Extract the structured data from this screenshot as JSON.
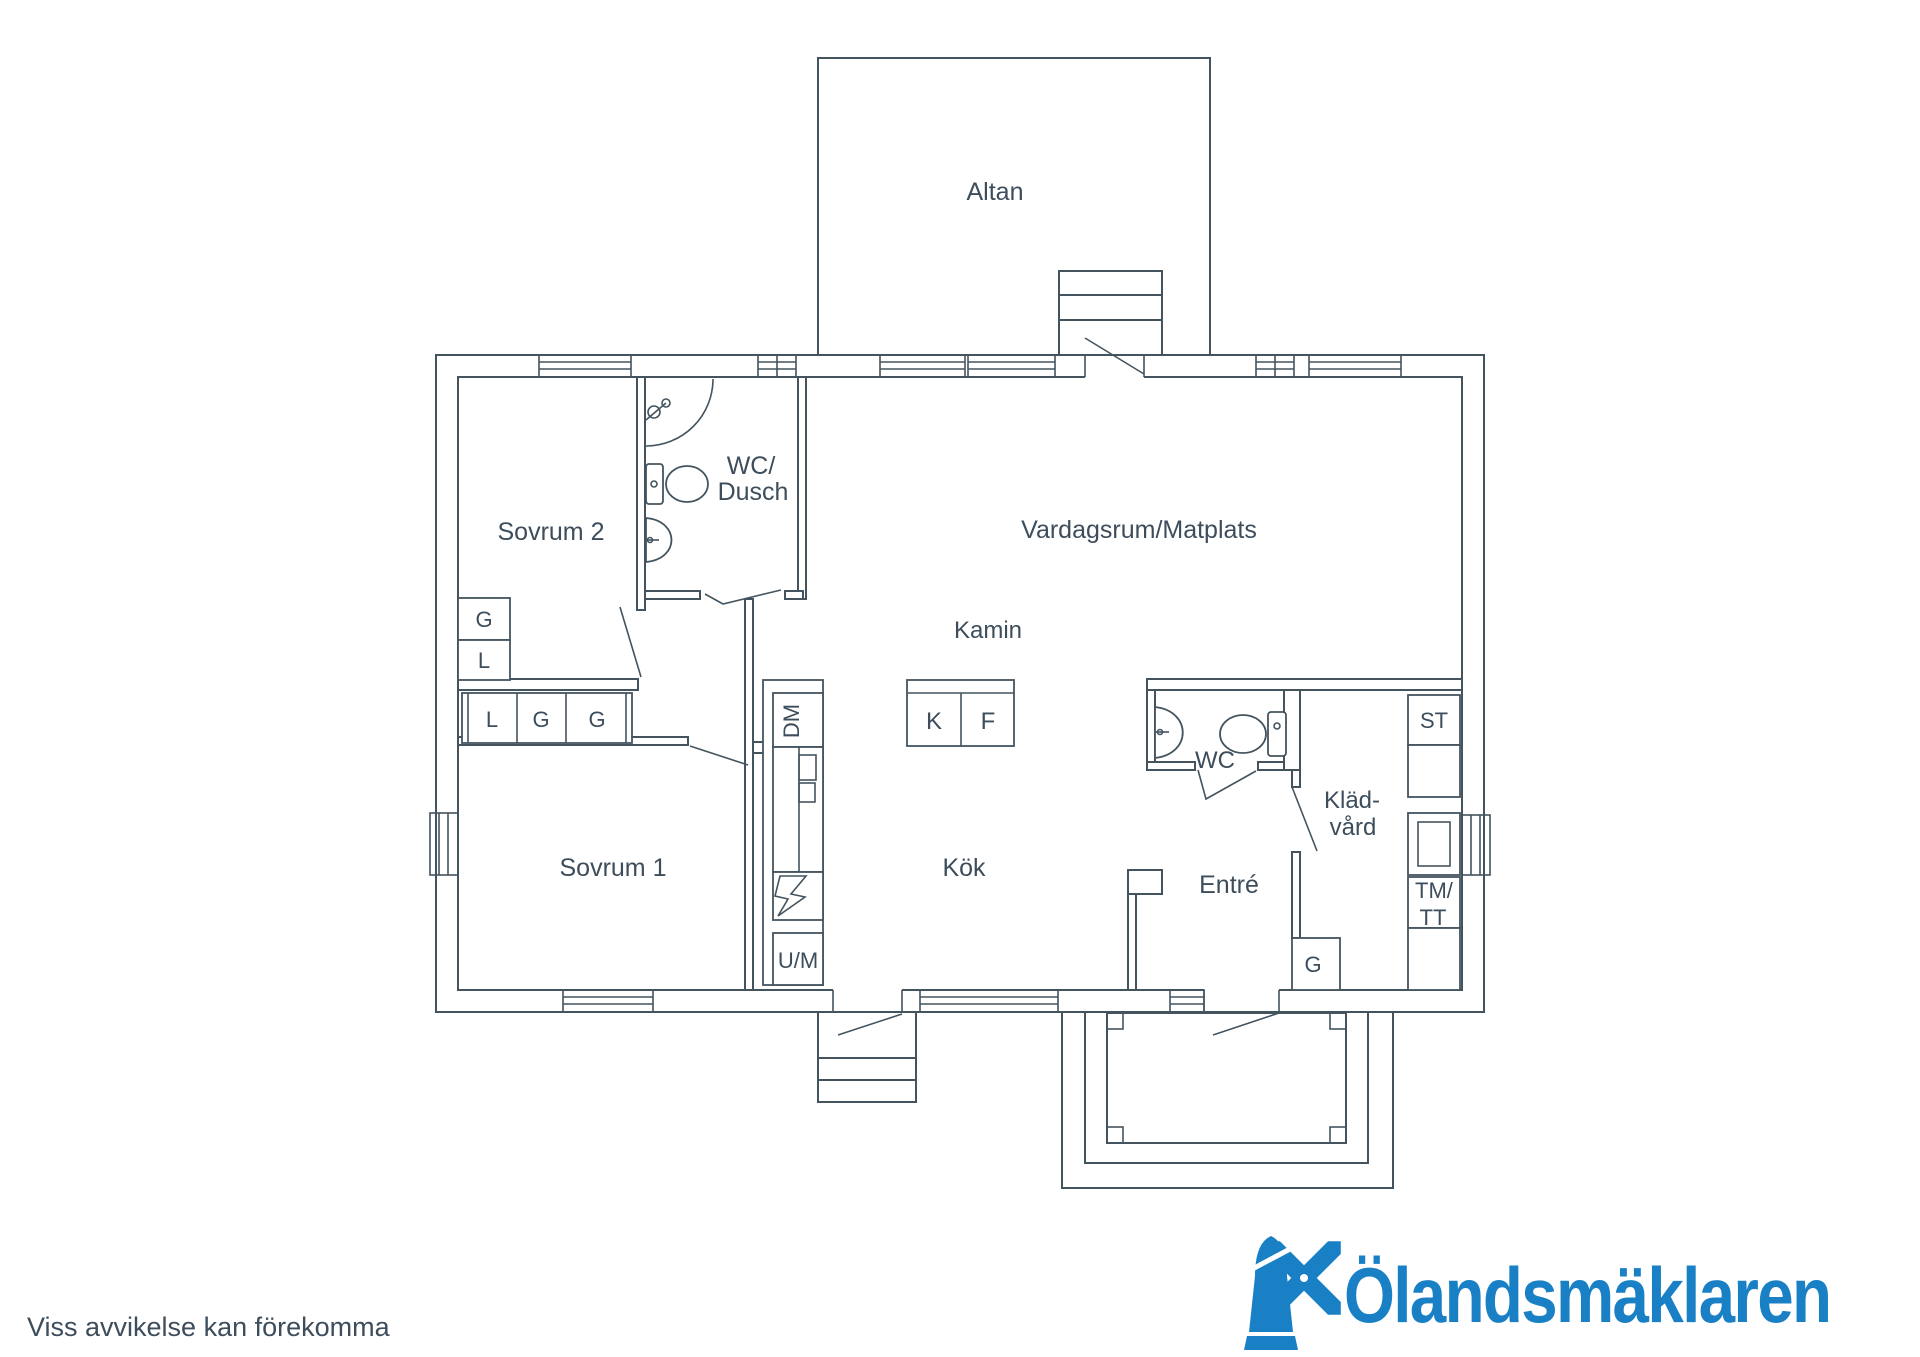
{
  "colors": {
    "line": "#44545f",
    "text": "#3d4d5b",
    "logo": "#1a80c5",
    "background": "#ffffff"
  },
  "footer": {
    "disclaimer": "Viss avvikelse kan förekomma"
  },
  "brand": {
    "name": "Ölandsmäklaren",
    "icon": "windmill-icon"
  },
  "plan": {
    "labels": [
      {
        "id": "label-altan",
        "t": "Altan",
        "x": 995,
        "y": 200,
        "fs": 25
      },
      {
        "id": "label-sovrum-2",
        "t": "Sovrum 2",
        "x": 551,
        "y": 540,
        "fs": 25
      },
      {
        "id": "label-wc-dusch-line1",
        "t": "WC/",
        "x": 751,
        "y": 474,
        "fs": 25
      },
      {
        "id": "label-wc-dusch-line2",
        "t": "Dusch",
        "x": 753,
        "y": 500,
        "fs": 25
      },
      {
        "id": "label-vardagsrum-matplats",
        "t": "Vardagsrum/Matplats",
        "x": 1139,
        "y": 538,
        "fs": 25
      },
      {
        "id": "label-kamin",
        "t": "Kamin",
        "x": 988,
        "y": 638,
        "fs": 24
      },
      {
        "id": "label-fridge-k",
        "t": "K",
        "x": 934,
        "y": 729,
        "fs": 24
      },
      {
        "id": "label-freezer-f",
        "t": "F",
        "x": 988,
        "y": 729,
        "fs": 24
      },
      {
        "id": "label-g-sovrum2",
        "t": "G",
        "x": 484,
        "y": 627,
        "fs": 22
      },
      {
        "id": "label-l-sovrum2",
        "t": "L",
        "x": 484,
        "y": 668,
        "fs": 22
      },
      {
        "id": "label-l-closet",
        "t": "L",
        "x": 492,
        "y": 727,
        "fs": 22
      },
      {
        "id": "label-g-closet-1",
        "t": "G",
        "x": 541,
        "y": 727,
        "fs": 22
      },
      {
        "id": "label-g-closet-2",
        "t": "G",
        "x": 597,
        "y": 727,
        "fs": 22
      },
      {
        "id": "label-dm",
        "t": "DM",
        "x": 799,
        "y": 721,
        "fs": 22,
        "rot": -90
      },
      {
        "id": "label-um",
        "t": "U/M",
        "x": 798,
        "y": 968,
        "fs": 22
      },
      {
        "id": "label-sovrum-1",
        "t": "Sovrum 1",
        "x": 613,
        "y": 876,
        "fs": 25
      },
      {
        "id": "label-kok",
        "t": "Kök",
        "x": 964,
        "y": 876,
        "fs": 25
      },
      {
        "id": "label-wc",
        "t": "WC",
        "x": 1215,
        "y": 768,
        "fs": 24
      },
      {
        "id": "label-entre",
        "t": "Entré",
        "x": 1229,
        "y": 893,
        "fs": 25
      },
      {
        "id": "label-kladvard-line1",
        "t": "Kläd-",
        "x": 1352,
        "y": 808,
        "fs": 24
      },
      {
        "id": "label-kladvard-line2",
        "t": "vård",
        "x": 1353,
        "y": 835,
        "fs": 24
      },
      {
        "id": "label-st",
        "t": "ST",
        "x": 1434,
        "y": 728,
        "fs": 22
      },
      {
        "id": "label-tm",
        "t": "TM/",
        "x": 1434,
        "y": 898,
        "fs": 22
      },
      {
        "id": "label-tt",
        "t": "TT",
        "x": 1433,
        "y": 925,
        "fs": 22
      },
      {
        "id": "label-g-entre",
        "t": "G",
        "x": 1313,
        "y": 972,
        "fs": 22
      }
    ]
  }
}
